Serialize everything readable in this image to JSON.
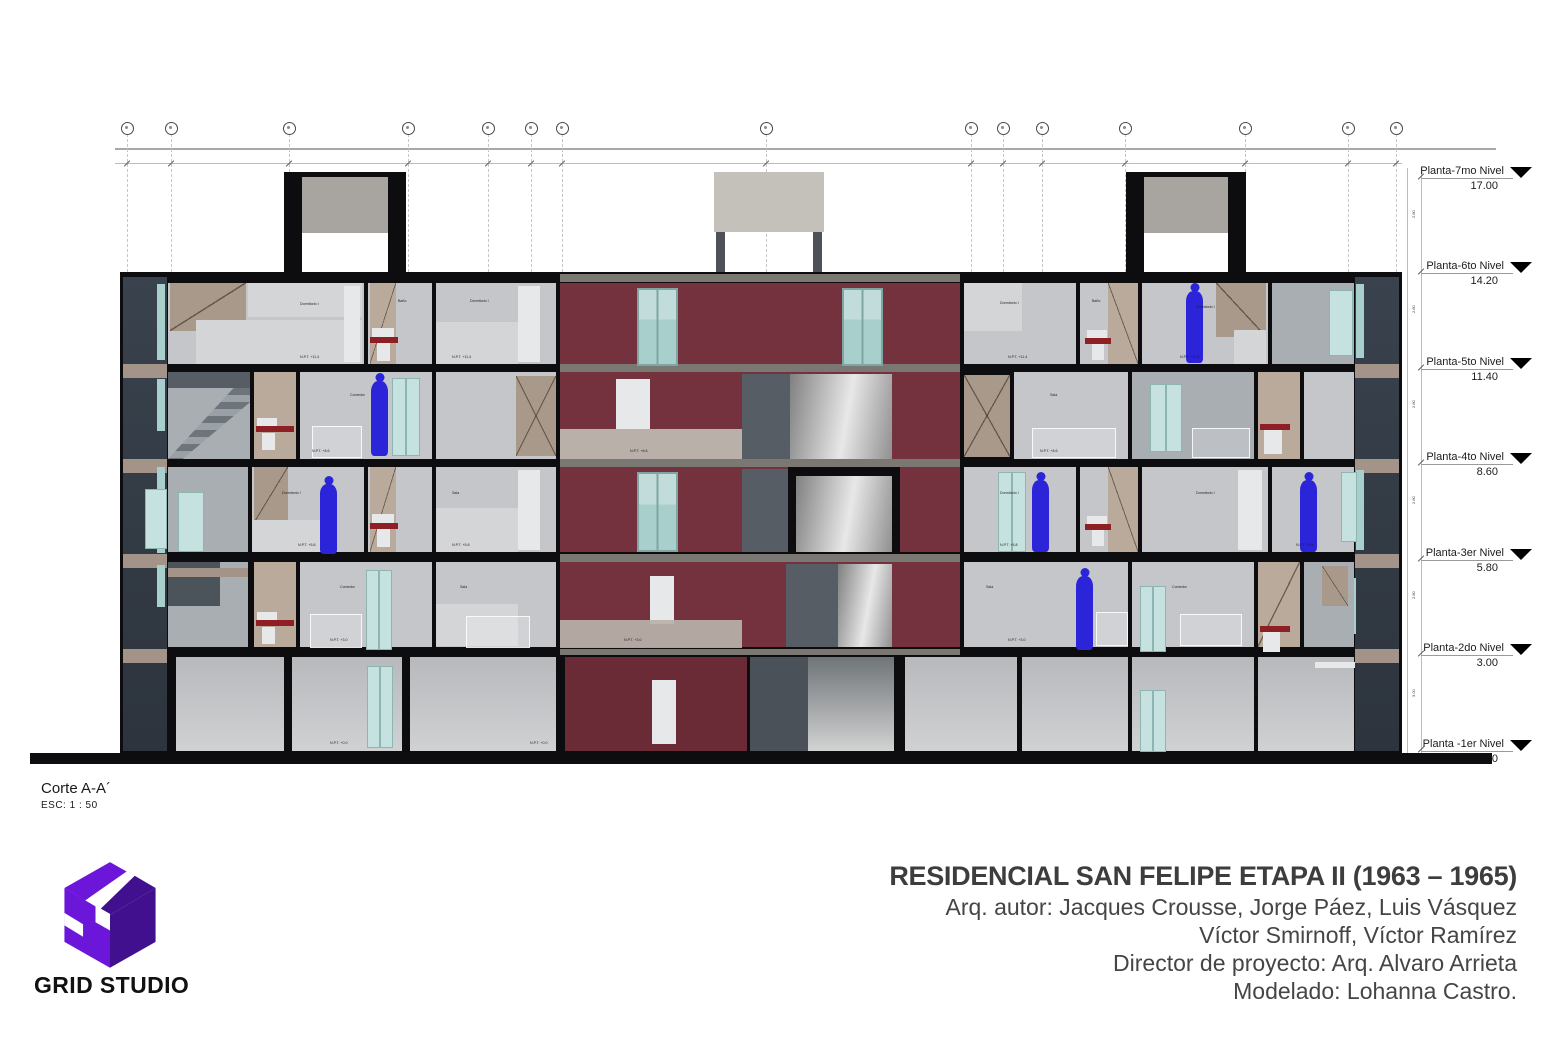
{
  "palette": {
    "wall": "#0d0d0f",
    "slate": "#39424d",
    "slate_dark": "#2d343d",
    "maroon": "#74313e",
    "maroon_dark": "#6a2b36",
    "room1": "#c4c6c9",
    "room2": "#a9aeb2",
    "room3": "#d4d5d7",
    "white_panel": "#e7e8e9",
    "tan1": "#a9998b",
    "tan2": "#b9aa9c",
    "band": "#a39388",
    "teal": "#a9cfcc",
    "teal_light": "#c6e2e0",
    "corridor": "#b9b1a9",
    "figure": "#2b24d8",
    "sink_red": "#8e1f24",
    "dark_panel": "#565d64",
    "ground_panel_top": "#b7b9bc",
    "ground_panel_bottom": "#d0d1d3",
    "logo_bright": "#6c16d9",
    "logo_dark": "#40108f",
    "title_color": "#3d3d3d"
  },
  "drawing": {
    "corte_label": "Corte A-A´",
    "scale_label": "ESC:  1 : 50",
    "levels": [
      {
        "name": "Planta-7mo Nivel",
        "value": "17.00"
      },
      {
        "name": "Planta-6to Nivel",
        "value": "14.20"
      },
      {
        "name": "Planta-5to Nivel",
        "value": "11.40"
      },
      {
        "name": "Planta-4to Nivel",
        "value": "8.60"
      },
      {
        "name": "Planta-3er Nivel",
        "value": "5.80"
      },
      {
        "name": "Planta-2do Nivel",
        "value": "3.00"
      },
      {
        "name": "Planta -1er Nivel",
        "value": "0.00"
      }
    ],
    "level_gaps": [
      "2.80",
      "2.80",
      "2.80",
      "2.80",
      "2.80",
      "3.00"
    ],
    "npt": {
      "f5": "N.P.T. +11.4",
      "f4": "N.P.T. +8.6",
      "f3": "N.P.T. +5.8",
      "f2": "N.P.T. +3.0",
      "f1": "N.P.T. +0.0"
    },
    "rooms": {
      "dormitorio": "Dormitorio I",
      "bano": "Baño",
      "sala": "Sala",
      "comedor": "Comedor"
    }
  },
  "footer": {
    "logo_text": "GRID STUDIO",
    "title": "RESIDENCIAL SAN FELIPE ETAPA II (1963 – 1965)",
    "credits": [
      "Arq. autor: Jacques Crousse, Jorge Páez, Luis Vásquez",
      "Víctor Smirnoff, Víctor Ramírez",
      "Director de proyecto: Arq. Alvaro Arrieta",
      "Modelado: Lohanna Castro."
    ]
  }
}
